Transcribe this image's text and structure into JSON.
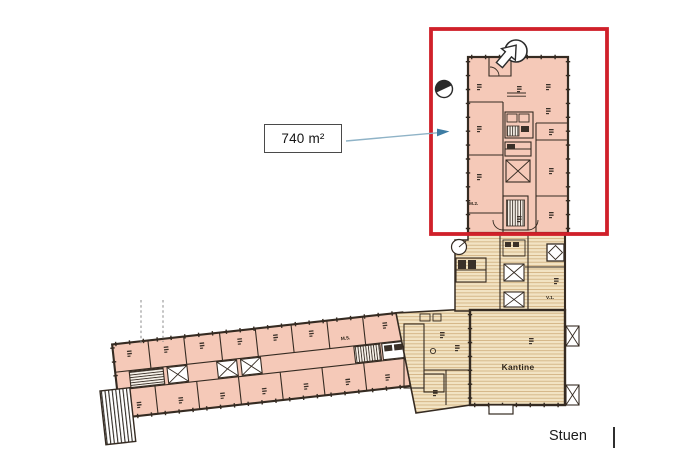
{
  "canvas": {
    "width": 687,
    "height": 466,
    "background": "#ffffff"
  },
  "annotation": {
    "area_label": "740 m²",
    "highlight_color": "#d0202a",
    "arrow_line_color": "#8fb3c7",
    "arrow_head_color": "#3d7ca3"
  },
  "caption": {
    "floor_label": "Stuen"
  },
  "plan": {
    "labels": {
      "kantine": "Kantine",
      "m2": "M.2.",
      "v1": "V.1.",
      "m5": "M.5."
    },
    "colors": {
      "room_fill": "#f5c9b8",
      "service_fill": "#f2e3c3",
      "service_hatch_line": "#cfae7d",
      "wall": "#352b22"
    }
  },
  "icons": {
    "north_arrow": "↗",
    "section_marker": "◐"
  }
}
